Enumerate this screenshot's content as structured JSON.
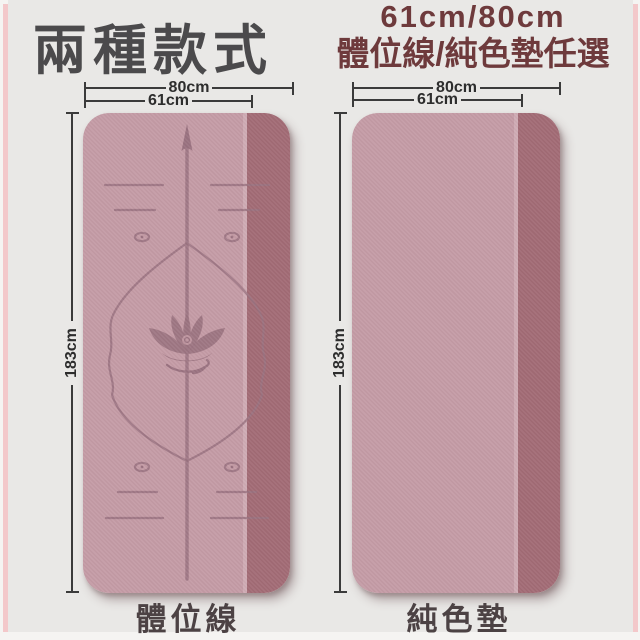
{
  "header": {
    "title": "兩種款式",
    "size_options": "61cm/80cm",
    "style_options": "體位線/純色墊任選"
  },
  "mats": [
    {
      "id": "alignment-line-mat",
      "name": "體位線",
      "width_total": "80cm",
      "width_mat": "61cm",
      "length": "183cm",
      "features": [
        "alignment-lines",
        "lotus-emblem",
        "up-arrow-guide"
      ]
    },
    {
      "id": "solid-color-mat",
      "name": "純色墊",
      "width_total": "80cm",
      "width_mat": "61cm",
      "length": "183cm",
      "features": []
    }
  ],
  "colors": {
    "background": "#e9e8e6",
    "edge_accent_pink": "#f3c8ca",
    "mat_body": "#c49ba5",
    "mat_side_strip": "#a26b75",
    "mat_seam_highlight": "#d6b3bb",
    "mat_design_lines": "#9a7280",
    "title_text": "#4b4a4c",
    "subtitle_text": "#6e3a3c",
    "dimension_lines": "#3b3b3b",
    "label_text": "#4c4244"
  }
}
